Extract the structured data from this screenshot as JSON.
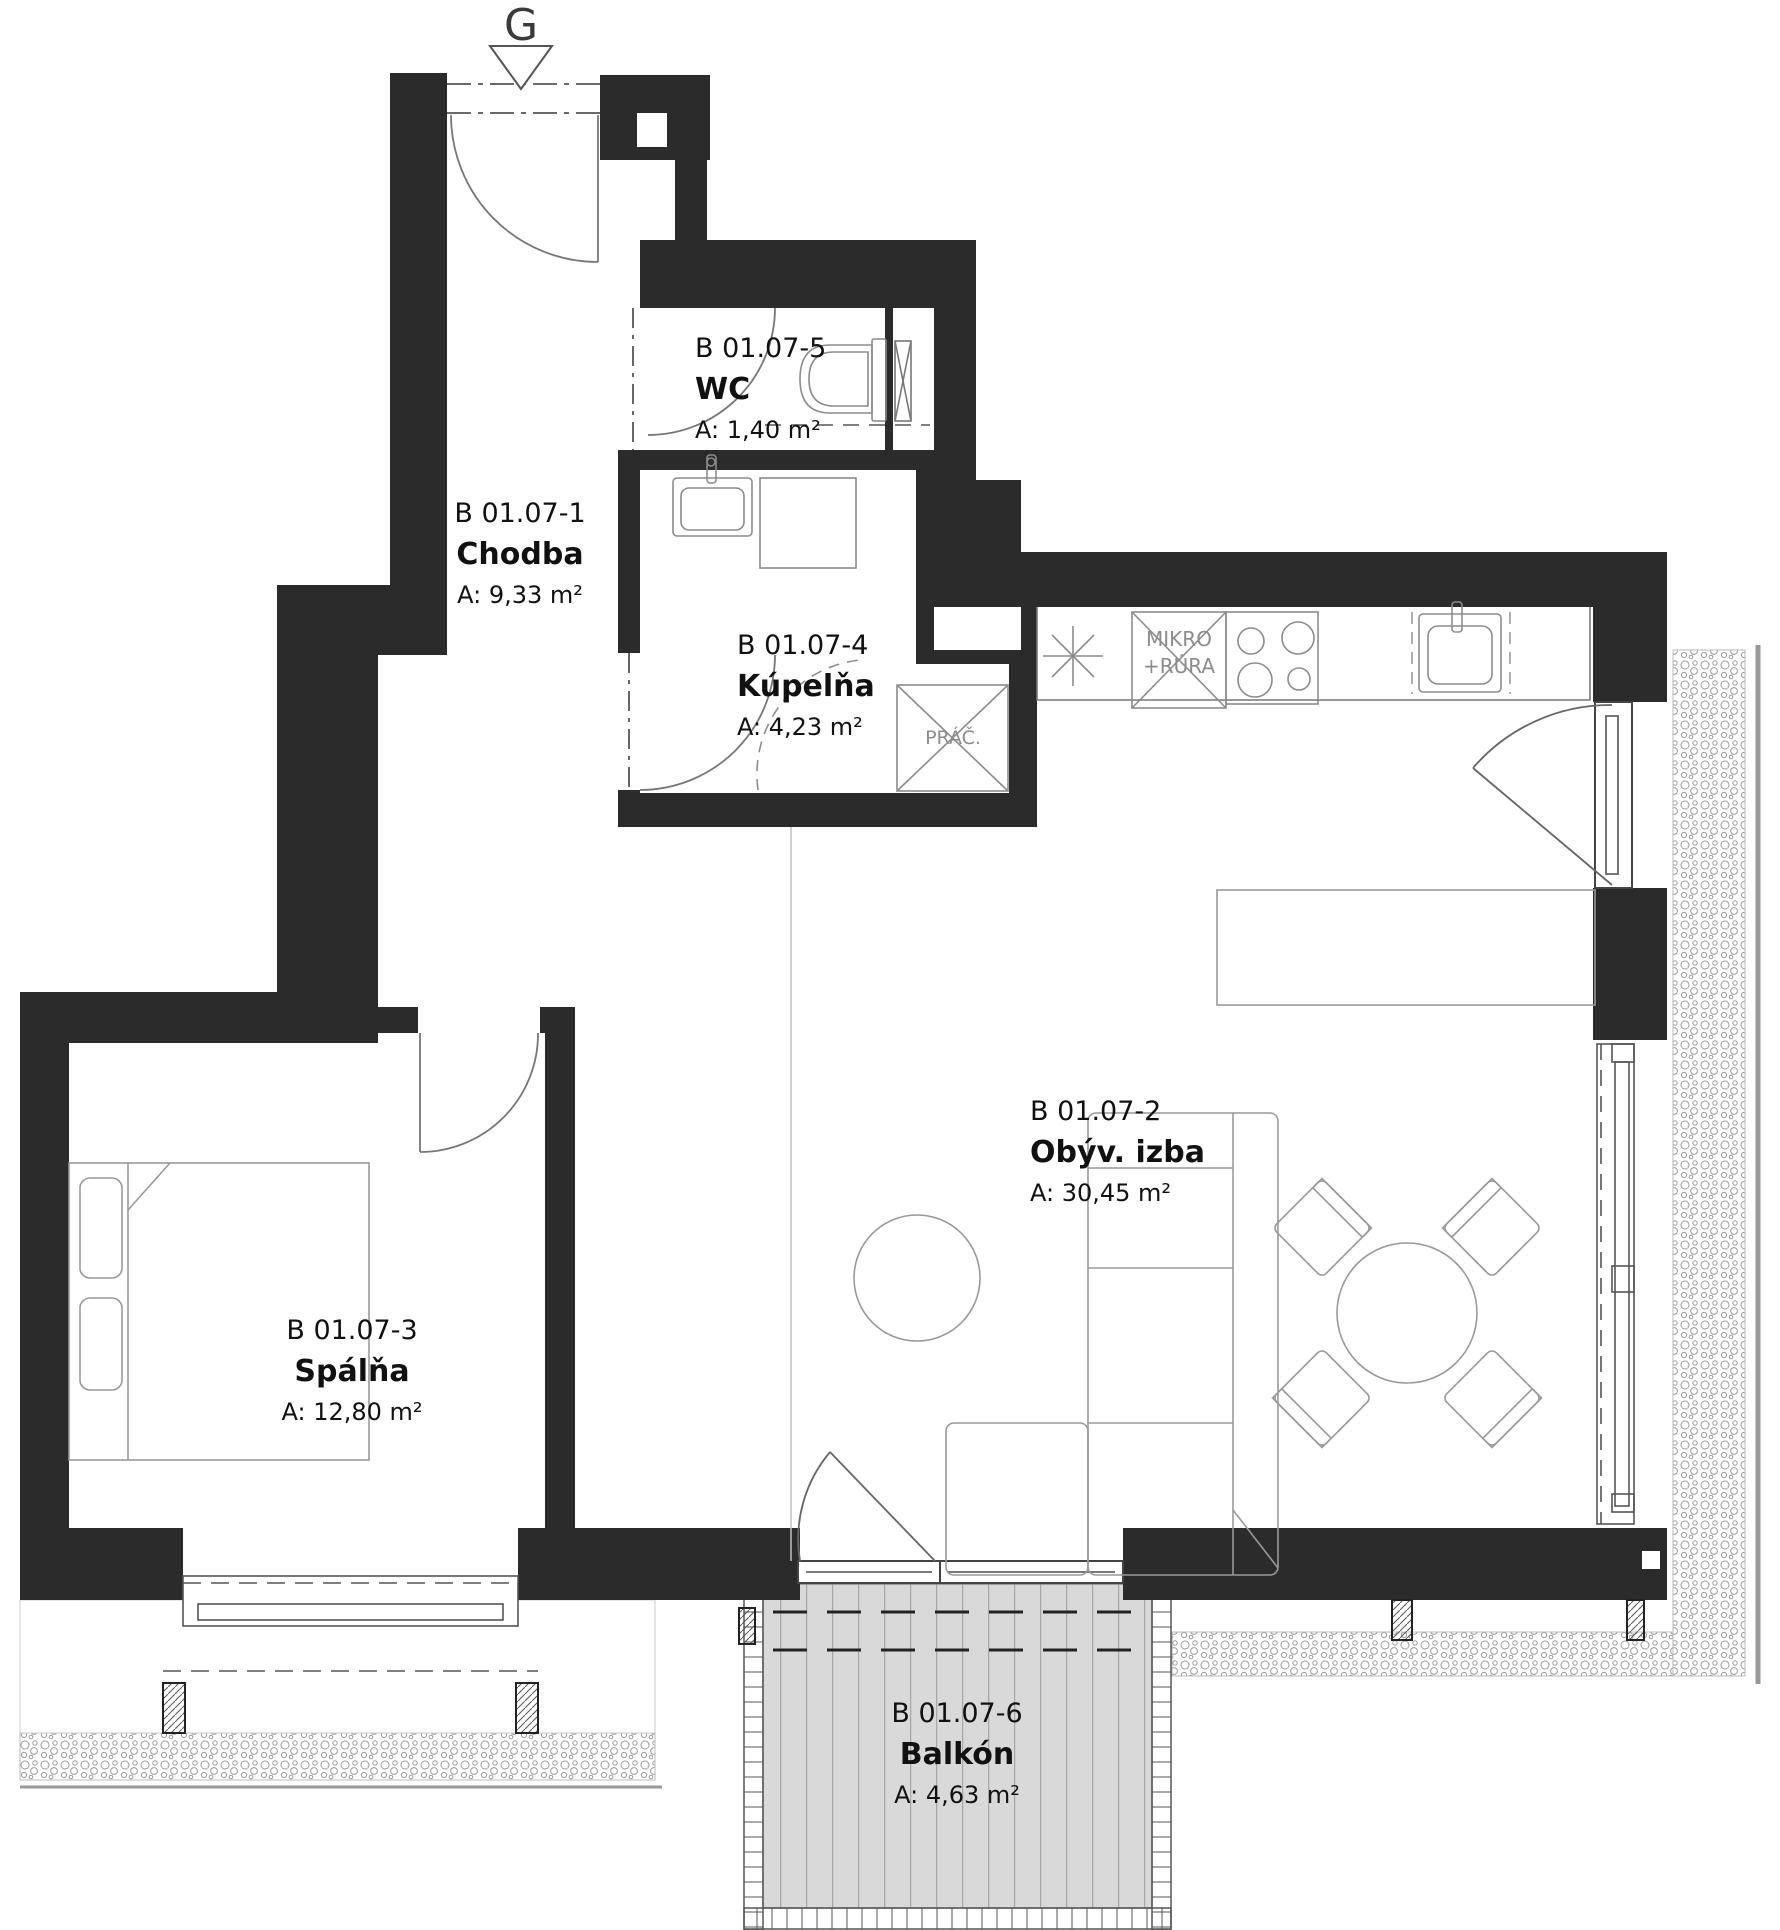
{
  "entrance_marker": "G",
  "rooms": [
    {
      "id": "B 01.07-1",
      "name": "Chodba",
      "area": "A: 9,33 m²"
    },
    {
      "id": "B 01.07-2",
      "name": "Obýv. izba",
      "area": "A: 30,45 m²"
    },
    {
      "id": "B 01.07-3",
      "name": "Spálňa",
      "area": "A: 12,80 m²"
    },
    {
      "id": "B 01.07-4",
      "name": "Kúpelňa",
      "area": "A: 4,23 m²"
    },
    {
      "id": "B 01.07-5",
      "name": "WC",
      "area": "A: 1,40 m²"
    },
    {
      "id": "B 01.07-6",
      "name": "Balkón",
      "area": "A: 4,63 m²"
    }
  ],
  "kitchen_labels": {
    "micro_line1": "MIKRO",
    "micro_line2": "+RÚRA"
  },
  "bathroom_labels": {
    "washer": "PRÁČ."
  },
  "colors": {
    "wall": "#2b2b2b",
    "furniture_line": "#666666",
    "deck_fill": "#d9d9d9",
    "pebble_line": "#9a9a9a",
    "text": "#111111",
    "muted_text": "#8c8c8c"
  }
}
